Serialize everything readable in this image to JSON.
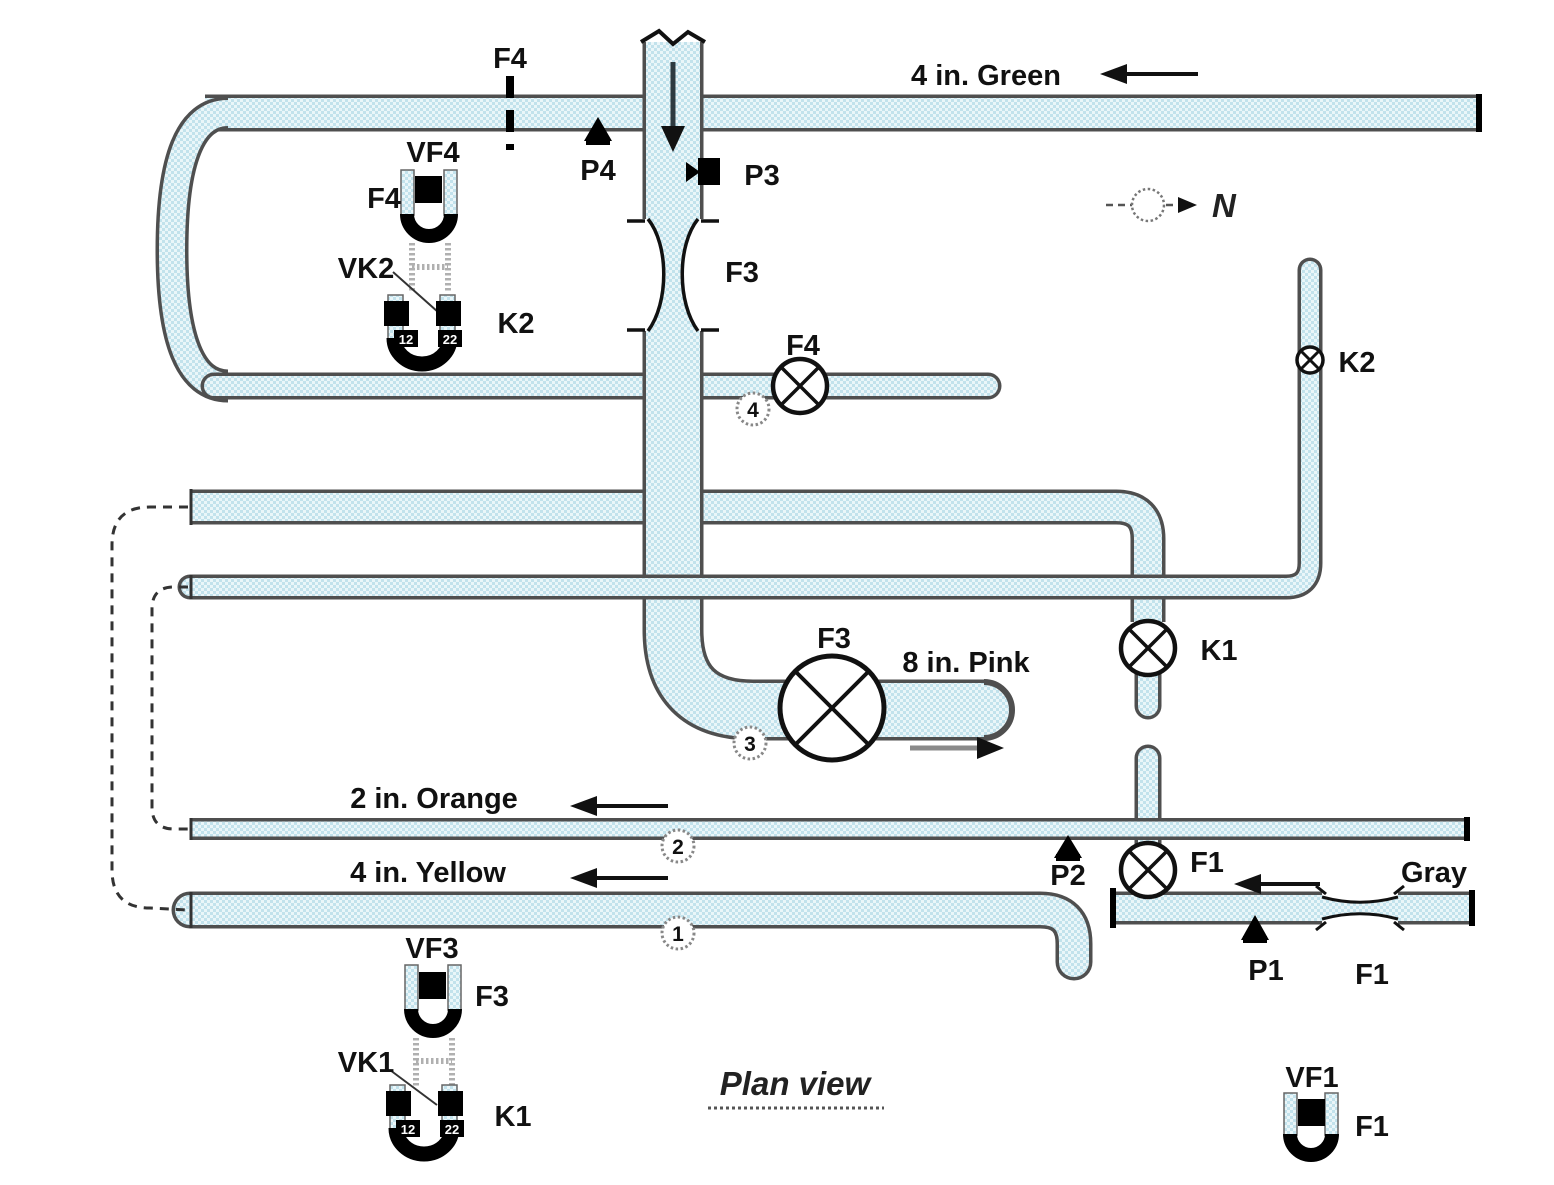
{
  "diagram": {
    "title": "Plan view",
    "compass_label": "N",
    "pipe_labels": {
      "green": "4 in. Green",
      "pink": "8 in. Pink",
      "orange": "2 in. Orange",
      "yellow": "4 in. Yellow",
      "gray": "Gray"
    },
    "valve_labels": {
      "f4": "F4",
      "f3": "F3",
      "f1": "F1",
      "k1": "K1",
      "k2": "K2"
    },
    "pressure_taps": {
      "p1": "P1",
      "p2": "P2",
      "p3": "P3",
      "p4": "P4"
    },
    "flow_meters": {
      "f4_orifice": "F4",
      "f3_venturi": "F3",
      "f1_venturi": "F1"
    },
    "sensor_labels": {
      "vf4": "VF4",
      "vf3": "VF3",
      "vf1": "VF1",
      "vk2": "VK2",
      "vk1": "VK1",
      "f4": "F4",
      "f3": "F3",
      "f1": "F1",
      "k2": "K2",
      "k1": "K1",
      "port_left": "12",
      "port_right": "22"
    },
    "junction_numbers": {
      "j1": "1",
      "j2": "2",
      "j3": "3",
      "j4": "4"
    },
    "colors": {
      "pipe_fill": "#c2e2ec",
      "pipe_fill_light": "#eaf6f9",
      "pipe_outline": "#4f4f4f",
      "symbol_black": "#111111"
    }
  }
}
